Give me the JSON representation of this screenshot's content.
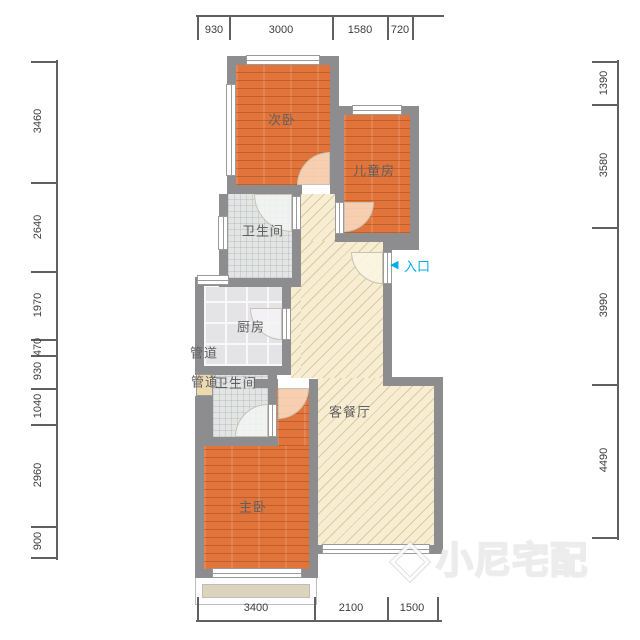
{
  "labels": {
    "secondary_bedroom": "次卧",
    "children_room": "儿童房",
    "bathroom_upper": "卫生间",
    "kitchen": "厨房",
    "duct_1": "管道",
    "duct_2": "管道",
    "bathroom_lower": "卫生间",
    "living_dining": "客餐厅",
    "master_bedroom": "主卧"
  },
  "entrance": {
    "arrow": "◀",
    "label": "入口",
    "color": "#00aeef"
  },
  "dimensions": {
    "top": [
      "930",
      "3000",
      "1580",
      "720"
    ],
    "left": [
      "3460",
      "2640",
      "1970",
      "470",
      "930",
      "1040",
      "2960",
      "900"
    ],
    "right": [
      "1390",
      "3580",
      "3990",
      "4490"
    ],
    "bottom": [
      "3400",
      "2100",
      "1500"
    ]
  },
  "watermark": {
    "text": "小尼宅配"
  },
  "colors": {
    "wall": "#8d8d90",
    "wood_floor": "#e0743a",
    "hatch_floor": "#f7edd2",
    "tile_floor": "#e4e4e6",
    "entrance_accent": "#00aeef"
  }
}
